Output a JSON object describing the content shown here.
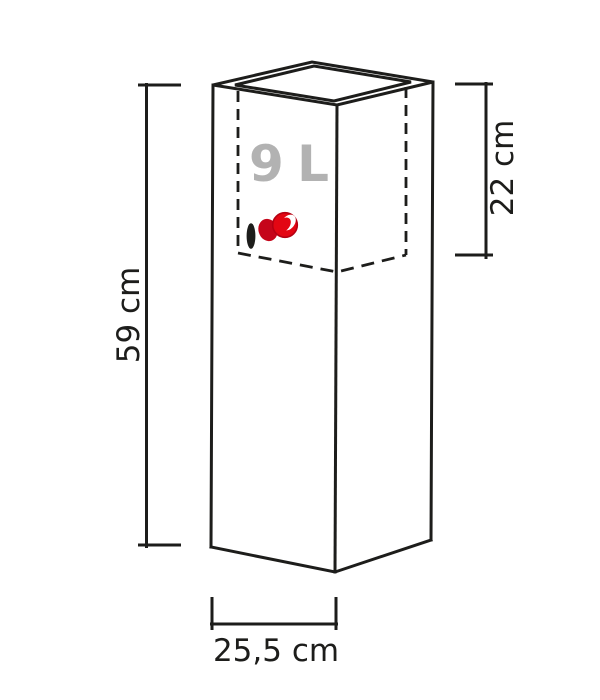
{
  "diagram": {
    "volume_label": "9 L",
    "dimensions": {
      "height_label": "59 cm",
      "insert_depth_label": "22 cm",
      "width_label": "25,5 cm"
    },
    "colors": {
      "line": "#1d1d1b",
      "volume_text": "#b2b2b2",
      "indicator_red": "#e30613",
      "indicator_red_dark": "#c5051a",
      "indicator_highlight": "#ffffff",
      "background": "#ffffff"
    },
    "icons": {
      "water_level_indicator": "water-level-indicator-icon",
      "drainage_hole": "drainage-hole-icon"
    }
  }
}
